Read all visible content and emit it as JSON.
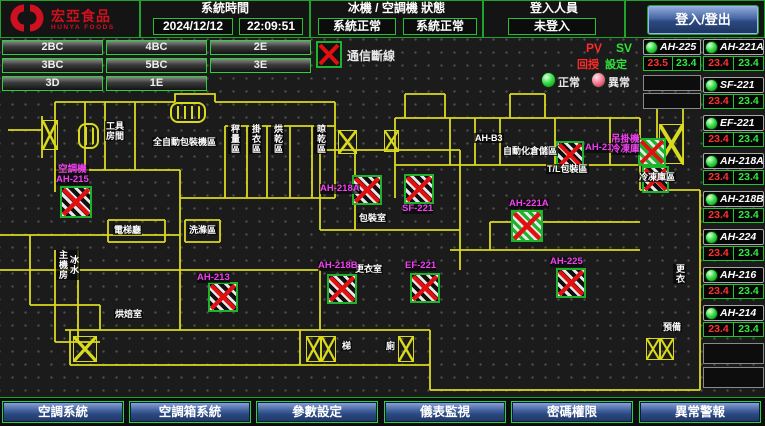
{
  "header": {
    "logo_title": "宏亞食品",
    "logo_subtitle": "HUNYA FOODS",
    "system_time_label": "系統時間",
    "date": "2024/12/12",
    "time": "22:09:51",
    "hvac_status_label": "冰機 / 空調機 狀態",
    "chiller_status": "系統正常",
    "ahu_status": "系統正常",
    "login_label": "登入人員",
    "login_value": "未登入",
    "login_button": "登入/登出"
  },
  "floor_buttons": [
    "2BC",
    "4BC",
    "2E",
    "3BC",
    "5BC",
    "3E",
    "3D",
    "1E"
  ],
  "legend": {
    "comm_fail": "通信斷線",
    "pv": "PV",
    "sv": "SV",
    "pv_caption": "回授",
    "sv_caption": "設定",
    "normal": "正常",
    "abnormal": "異常"
  },
  "device_columns": {
    "col_a": [
      {
        "name": "AH-225",
        "pv": "23.5",
        "sv": "23.4"
      }
    ],
    "col_b": [
      {
        "name": "AH-221A",
        "pv": "23.4",
        "sv": "23.4"
      },
      {
        "name": "SF-221",
        "pv": "23.4",
        "sv": "23.4"
      },
      {
        "name": "EF-221",
        "pv": "23.4",
        "sv": "23.4"
      },
      {
        "name": "AH-218A",
        "pv": "23.4",
        "sv": "23.4"
      },
      {
        "name": "AH-218B",
        "pv": "23.4",
        "sv": "23.4"
      },
      {
        "name": "AH-224",
        "pv": "23.4",
        "sv": "23.4"
      },
      {
        "name": "AH-216",
        "pv": "23.4",
        "sv": "23.4"
      },
      {
        "name": "AH-214",
        "pv": "23.4",
        "sv": "23.4"
      }
    ]
  },
  "floor_plan": {
    "room_labels": [
      {
        "t": "工具\n房間",
        "x": 105,
        "y": 121,
        "v": false
      },
      {
        "t": "全自動包裝機區",
        "x": 152,
        "y": 137,
        "v": false
      },
      {
        "t": "秤量區",
        "x": 228,
        "y": 124,
        "v": true
      },
      {
        "t": "掛衣區",
        "x": 249,
        "y": 124,
        "v": true
      },
      {
        "t": "烘乾區",
        "x": 271,
        "y": 124,
        "v": true
      },
      {
        "t": "晾乾區",
        "x": 314,
        "y": 124,
        "v": true
      },
      {
        "t": "AH-B3",
        "x": 474,
        "y": 133,
        "v": false
      },
      {
        "t": "自動化倉儲區",
        "x": 502,
        "y": 146,
        "v": false
      },
      {
        "t": "T/L包裝區",
        "x": 546,
        "y": 164,
        "v": false
      },
      {
        "t": "冷凍庫區",
        "x": 638,
        "y": 172,
        "v": false
      },
      {
        "t": "包裝室",
        "x": 358,
        "y": 213,
        "v": false
      },
      {
        "t": "更衣室",
        "x": 354,
        "y": 264,
        "v": false
      },
      {
        "t": "電梯廳",
        "x": 113,
        "y": 225,
        "v": false
      },
      {
        "t": "洗滌區",
        "x": 188,
        "y": 225,
        "v": false
      },
      {
        "t": "冰水\n主機房",
        "x": 56,
        "y": 250,
        "v": true
      },
      {
        "t": "烘焙室",
        "x": 114,
        "y": 309,
        "v": false
      },
      {
        "t": "梯",
        "x": 341,
        "y": 341,
        "v": false
      },
      {
        "t": "廁",
        "x": 385,
        "y": 341,
        "v": false
      },
      {
        "t": "更衣",
        "x": 673,
        "y": 264,
        "v": true
      },
      {
        "t": "預備",
        "x": 662,
        "y": 322,
        "v": false
      }
    ],
    "equipment_labels": [
      {
        "t": "空調機\nAH-215",
        "x": 56,
        "y": 165
      },
      {
        "t": "AH-213",
        "x": 197,
        "y": 273
      },
      {
        "t": "AH-218A",
        "x": 320,
        "y": 184
      },
      {
        "t": "SF-221",
        "x": 402,
        "y": 204
      },
      {
        "t": "AH-218B",
        "x": 318,
        "y": 261
      },
      {
        "t": "EF-221",
        "x": 405,
        "y": 261
      },
      {
        "t": "AH-221A",
        "x": 509,
        "y": 199
      },
      {
        "t": "AH-225",
        "x": 550,
        "y": 257
      },
      {
        "t": "AH-214",
        "x": 585,
        "y": 143
      },
      {
        "t": "吊掛機\n冷凍庫",
        "x": 611,
        "y": 135
      }
    ],
    "offline_markers": [
      {
        "x": 60,
        "y": 186,
        "s": 32,
        "variant": "bw"
      },
      {
        "x": 208,
        "y": 282,
        "s": 30,
        "variant": "bw"
      },
      {
        "x": 352,
        "y": 175,
        "s": 30,
        "variant": "bw"
      },
      {
        "x": 404,
        "y": 174,
        "s": 30,
        "variant": "bw"
      },
      {
        "x": 327,
        "y": 274,
        "s": 30,
        "variant": "bw"
      },
      {
        "x": 410,
        "y": 273,
        "s": 30,
        "variant": "bw"
      },
      {
        "x": 511,
        "y": 210,
        "s": 32,
        "variant": "green"
      },
      {
        "x": 556,
        "y": 141,
        "s": 28,
        "variant": "bw"
      },
      {
        "x": 638,
        "y": 138,
        "s": 28,
        "variant": "green"
      },
      {
        "x": 556,
        "y": 268,
        "s": 30,
        "variant": "bw"
      },
      {
        "x": 642,
        "y": 166,
        "s": 27,
        "variant": "bw"
      }
    ],
    "stair_symbols": [
      {
        "x": 42,
        "y": 120,
        "w": 16,
        "h": 30
      },
      {
        "x": 338,
        "y": 130,
        "w": 19,
        "h": 24
      },
      {
        "x": 384,
        "y": 130,
        "w": 15,
        "h": 22
      },
      {
        "x": 659,
        "y": 124,
        "w": 25,
        "h": 40
      },
      {
        "x": 306,
        "y": 336,
        "w": 15,
        "h": 26
      },
      {
        "x": 321,
        "y": 336,
        "w": 15,
        "h": 26
      },
      {
        "x": 398,
        "y": 336,
        "w": 16,
        "h": 26
      },
      {
        "x": 73,
        "y": 336,
        "w": 24,
        "h": 26
      },
      {
        "x": 646,
        "y": 338,
        "w": 14,
        "h": 22
      },
      {
        "x": 660,
        "y": 338,
        "w": 14,
        "h": 22
      }
    ],
    "spiral_symbols": [
      {
        "x": 170,
        "y": 102,
        "w": 36,
        "h": 21
      },
      {
        "x": 78,
        "y": 123,
        "w": 21,
        "h": 26
      }
    ]
  },
  "footer_buttons": [
    "空調系統",
    "空調箱系統",
    "參數設定",
    "儀表監視",
    "密碼權限",
    "異常警報"
  ]
}
